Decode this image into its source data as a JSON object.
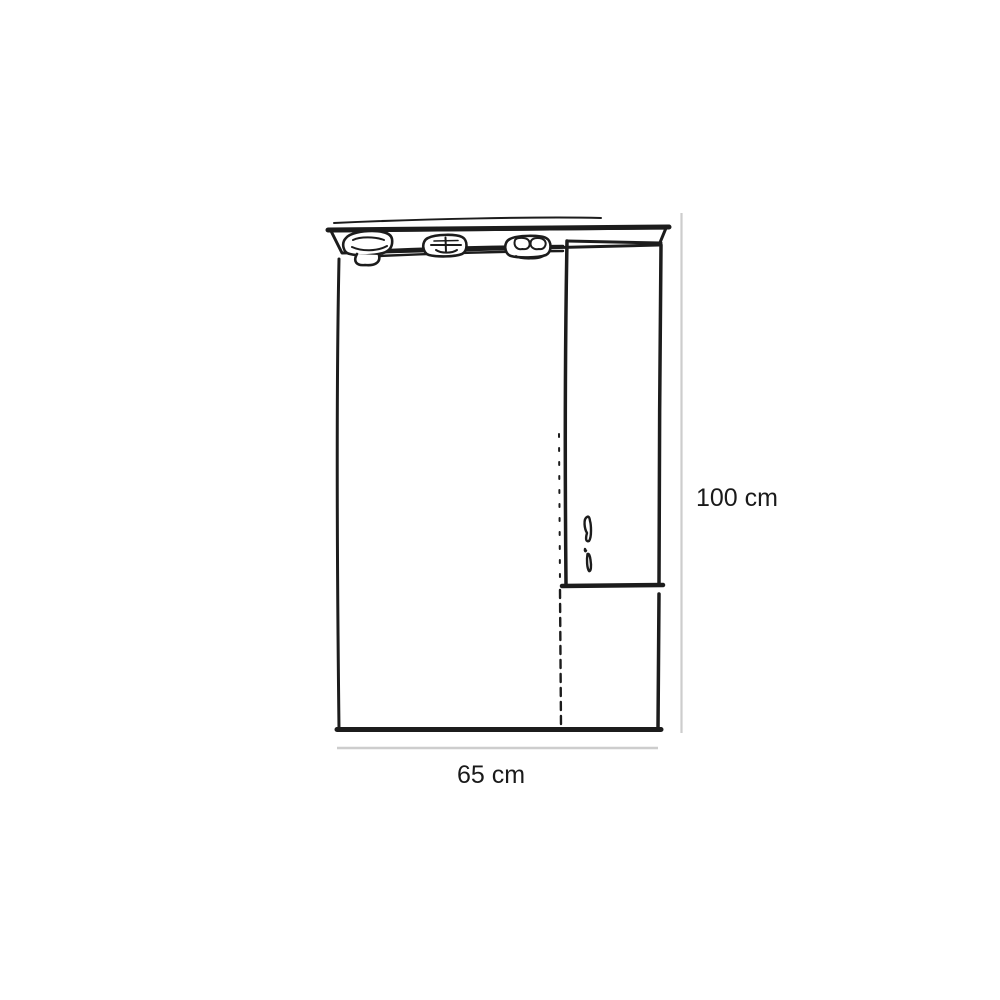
{
  "diagram": {
    "subject": "bathroom mirror cabinet with spotlight canopy, side cupboard door and open lower shelf",
    "style": "hand-sketched monochrome product dimension drawing",
    "dimensions": {
      "height_label": "100 cm",
      "width_label": "65 cm"
    },
    "spotlight_count": 3,
    "colors": {
      "line": "#1c1c1c",
      "dimension_line": "#cdcdcd",
      "label_text": "#1a1a1a",
      "background": "#ffffff"
    }
  }
}
